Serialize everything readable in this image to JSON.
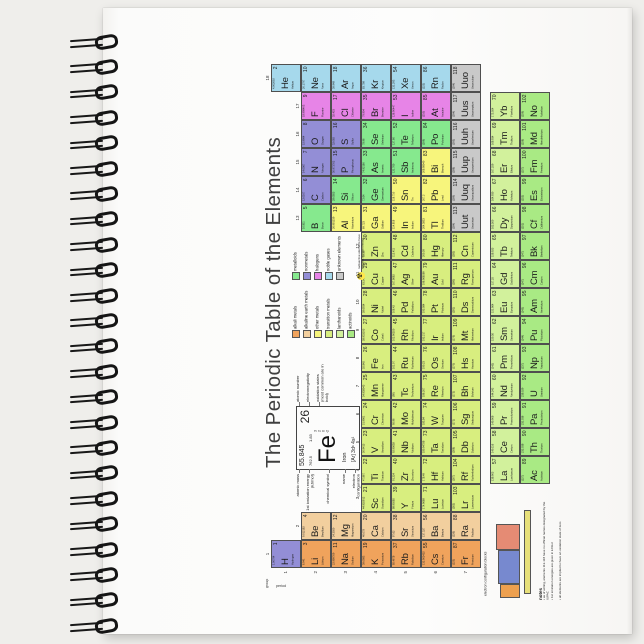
{
  "product": {
    "background_color": "#efeeeb",
    "page_color": "#fcfcfb",
    "spiral_coil_count": 24
  },
  "poster": {
    "title": "The Periodic Table of the Elements",
    "axis": {
      "group_word": "group",
      "period_word": "period",
      "group_numbers": [
        "1",
        "2",
        "3",
        "4",
        "5",
        "6",
        "7",
        "8",
        "9",
        "10",
        "11",
        "12",
        "13",
        "14",
        "15",
        "16",
        "17",
        "18"
      ],
      "period_numbers": [
        "1",
        "2",
        "3",
        "4",
        "5",
        "6",
        "7"
      ]
    },
    "categories": {
      "alk": {
        "label": "alkali metals",
        "color": "#f0a35c"
      },
      "ae": {
        "label": "alkaline earth metals",
        "color": "#f2cf9e"
      },
      "pm": {
        "label": "other metals",
        "color": "#f7f57c"
      },
      "tm": {
        "label": "transition metals",
        "color": "#d8ee7f"
      },
      "lan": {
        "label": "lanthanoids",
        "color": "#d2f19c"
      },
      "act": {
        "label": "actinoids",
        "color": "#a9ea84"
      },
      "md": {
        "label": "metalloids",
        "color": "#86e98e"
      },
      "nm": {
        "label": "nonmetals",
        "color": "#938ed6"
      },
      "hal": {
        "label": "halogens",
        "color": "#e784e7"
      },
      "ng": {
        "label": "noble gases",
        "color": "#a6d9ec"
      },
      "unk": {
        "label": "unknown elements",
        "color": "#c9c9c9"
      }
    },
    "legend": {
      "left_column": [
        "alk",
        "ae",
        "pm",
        "tm",
        "lan",
        "act"
      ],
      "right_column": [
        "md",
        "nm",
        "hal",
        "ng",
        "unk"
      ],
      "radioactive_icon": "☢",
      "radioactive_note": "radioactive elements have masses in parentheses"
    },
    "feature_cell": {
      "atomic_mass": "55.845",
      "ionization_energy": "762.5",
      "electronegativity": "1.83",
      "atomic_number": "26",
      "symbol": "Fe",
      "name": "Iron",
      "electron_configuration": "[Ar] 3d⁶ 4s²",
      "oxidation_states": [
        "3",
        "2",
        "0",
        "-2"
      ],
      "labels_left": [
        "atomic mass",
        "1st ionization energy (kJ/mol)",
        "chemical symbol",
        "name",
        "electron configuration"
      ],
      "labels_right": [
        "atomic number",
        "electronegativity",
        "oxidation states (most common are in bold)"
      ]
    },
    "blocks_diagram": {
      "caption": "electron configuration blocks",
      "blocks": [
        {
          "name": "s-block",
          "color": "#eda04f"
        },
        {
          "name": "d-block",
          "color": "#7789cf"
        },
        {
          "name": "p-block",
          "color": "#e58b74"
        },
        {
          "name": "f-block",
          "color": "#e7e07a"
        }
      ]
    },
    "notes": {
      "heading": "notes",
      "items": [
        "as of writing, elements 113-118 have no official names designated by the IUPAC",
        "1st ionization energies are given in kJ/mol",
        "all elements are implied to have an oxidation state of zero"
      ]
    },
    "element_fields": [
      "atomic_number",
      "symbol",
      "name",
      "atomic_mass",
      "column",
      "row",
      "category"
    ],
    "elements": [
      [
        1,
        "H",
        "Hydrogen",
        "1.00794",
        1,
        1,
        "nm"
      ],
      [
        2,
        "He",
        "Helium",
        "4.002602",
        18,
        1,
        "ng"
      ],
      [
        3,
        "Li",
        "Lithium",
        "6.941",
        1,
        2,
        "alk"
      ],
      [
        4,
        "Be",
        "Beryllium",
        "9.012182",
        2,
        2,
        "ae"
      ],
      [
        5,
        "B",
        "Boron",
        "10.811",
        13,
        2,
        "md"
      ],
      [
        6,
        "C",
        "Carbon",
        "12.0107",
        14,
        2,
        "nm"
      ],
      [
        7,
        "N",
        "Nitrogen",
        "14.0067",
        15,
        2,
        "nm"
      ],
      [
        8,
        "O",
        "Oxygen",
        "15.9994",
        16,
        2,
        "nm"
      ],
      [
        9,
        "F",
        "Fluorine",
        "18.998403",
        17,
        2,
        "hal"
      ],
      [
        10,
        "Ne",
        "Neon",
        "20.1797",
        18,
        2,
        "ng"
      ],
      [
        11,
        "Na",
        "Sodium",
        "22.989769",
        1,
        3,
        "alk"
      ],
      [
        12,
        "Mg",
        "Magnesium",
        "24.3050",
        2,
        3,
        "ae"
      ],
      [
        13,
        "Al",
        "Aluminium",
        "26.981539",
        13,
        3,
        "pm"
      ],
      [
        14,
        "Si",
        "Silicon",
        "28.0855",
        14,
        3,
        "md"
      ],
      [
        15,
        "P",
        "Phosphorus",
        "30.973762",
        15,
        3,
        "nm"
      ],
      [
        16,
        "S",
        "Sulfur",
        "32.065",
        16,
        3,
        "nm"
      ],
      [
        17,
        "Cl",
        "Chlorine",
        "35.453",
        17,
        3,
        "hal"
      ],
      [
        18,
        "Ar",
        "Argon",
        "39.948",
        18,
        3,
        "ng"
      ],
      [
        19,
        "K",
        "Potassium",
        "39.0983",
        1,
        4,
        "alk"
      ],
      [
        20,
        "Ca",
        "Calcium",
        "40.078",
        2,
        4,
        "ae"
      ],
      [
        21,
        "Sc",
        "Scandium",
        "44.955912",
        3,
        4,
        "tm"
      ],
      [
        22,
        "Ti",
        "Titanium",
        "47.867",
        4,
        4,
        "tm"
      ],
      [
        23,
        "V",
        "Vanadium",
        "50.9415",
        5,
        4,
        "tm"
      ],
      [
        24,
        "Cr",
        "Chromium",
        "51.9961",
        6,
        4,
        "tm"
      ],
      [
        25,
        "Mn",
        "Manganese",
        "54.938045",
        7,
        4,
        "tm"
      ],
      [
        26,
        "Fe",
        "Iron",
        "55.845",
        8,
        4,
        "tm"
      ],
      [
        27,
        "Co",
        "Cobalt",
        "58.933195",
        9,
        4,
        "tm"
      ],
      [
        28,
        "Ni",
        "Nickel",
        "58.6934",
        10,
        4,
        "tm"
      ],
      [
        29,
        "Cu",
        "Copper",
        "63.546",
        11,
        4,
        "tm"
      ],
      [
        30,
        "Zn",
        "Zinc",
        "65.38",
        12,
        4,
        "tm"
      ],
      [
        31,
        "Ga",
        "Gallium",
        "69.723",
        13,
        4,
        "pm"
      ],
      [
        32,
        "Ge",
        "Germanium",
        "72.64",
        14,
        4,
        "md"
      ],
      [
        33,
        "As",
        "Arsenic",
        "74.92160",
        15,
        4,
        "md"
      ],
      [
        34,
        "Se",
        "Selenium",
        "78.96",
        16,
        4,
        "md"
      ],
      [
        35,
        "Br",
        "Bromine",
        "79.904",
        17,
        4,
        "hal"
      ],
      [
        36,
        "Kr",
        "Krypton",
        "83.798",
        18,
        4,
        "ng"
      ],
      [
        37,
        "Rb",
        "Rubidium",
        "85.4678",
        1,
        5,
        "alk"
      ],
      [
        38,
        "Sr",
        "Strontium",
        "87.62",
        2,
        5,
        "ae"
      ],
      [
        39,
        "Y",
        "Yttrium",
        "88.90585",
        3,
        5,
        "tm"
      ],
      [
        40,
        "Zr",
        "Zirconium",
        "91.224",
        4,
        5,
        "tm"
      ],
      [
        41,
        "Nb",
        "Niobium",
        "92.90638",
        5,
        5,
        "tm"
      ],
      [
        42,
        "Mo",
        "Molybdenum",
        "95.96",
        6,
        5,
        "tm"
      ],
      [
        43,
        "Tc",
        "Technetium",
        "(98)",
        7,
        5,
        "tm"
      ],
      [
        44,
        "Ru",
        "Ruthenium",
        "101.07",
        8,
        5,
        "tm"
      ],
      [
        45,
        "Rh",
        "Rhodium",
        "102.90550",
        9,
        5,
        "tm"
      ],
      [
        46,
        "Pd",
        "Palladium",
        "106.42",
        10,
        5,
        "tm"
      ],
      [
        47,
        "Ag",
        "Silver",
        "107.8682",
        11,
        5,
        "tm"
      ],
      [
        48,
        "Cd",
        "Cadmium",
        "112.411",
        12,
        5,
        "tm"
      ],
      [
        49,
        "In",
        "Indium",
        "114.818",
        13,
        5,
        "pm"
      ],
      [
        50,
        "Sn",
        "Tin",
        "118.710",
        14,
        5,
        "pm"
      ],
      [
        51,
        "Sb",
        "Antimony",
        "121.760",
        15,
        5,
        "md"
      ],
      [
        52,
        "Te",
        "Tellurium",
        "127.60",
        16,
        5,
        "md"
      ],
      [
        53,
        "I",
        "Iodine",
        "126.90447",
        17,
        5,
        "hal"
      ],
      [
        54,
        "Xe",
        "Xenon",
        "131.293",
        18,
        5,
        "ng"
      ],
      [
        55,
        "Cs",
        "Caesium",
        "132.905452",
        1,
        6,
        "alk"
      ],
      [
        56,
        "Ba",
        "Barium",
        "137.327",
        2,
        6,
        "ae"
      ],
      [
        57,
        "La",
        "Lanthanum",
        "138.905",
        4,
        8,
        "lan"
      ],
      [
        58,
        "Ce",
        "Cerium",
        "140.116",
        5,
        8,
        "lan"
      ],
      [
        59,
        "Pr",
        "Praseodymium",
        "140.908",
        6,
        8,
        "lan"
      ],
      [
        60,
        "Nd",
        "Neodymium",
        "144.242",
        7,
        8,
        "lan"
      ],
      [
        61,
        "Pm",
        "Promethium",
        "(145)",
        8,
        8,
        "lan"
      ],
      [
        62,
        "Sm",
        "Samarium",
        "150.36",
        9,
        8,
        "lan"
      ],
      [
        63,
        "Eu",
        "Europium",
        "151.964",
        10,
        8,
        "lan"
      ],
      [
        64,
        "Gd",
        "Gadolinium",
        "157.25",
        11,
        8,
        "lan"
      ],
      [
        65,
        "Tb",
        "Terbium",
        "158.925",
        12,
        8,
        "lan"
      ],
      [
        66,
        "Dy",
        "Dysprosium",
        "162.500",
        13,
        8,
        "lan"
      ],
      [
        67,
        "Ho",
        "Holmium",
        "164.930",
        14,
        8,
        "lan"
      ],
      [
        68,
        "Er",
        "Erbium",
        "167.259",
        15,
        8,
        "lan"
      ],
      [
        69,
        "Tm",
        "Thulium",
        "168.934",
        16,
        8,
        "lan"
      ],
      [
        70,
        "Yb",
        "Ytterbium",
        "173.054",
        17,
        8,
        "lan"
      ],
      [
        71,
        "Lu",
        "Lutetium",
        "174.9668",
        3,
        6,
        "tm"
      ],
      [
        72,
        "Hf",
        "Hafnium",
        "178.49",
        4,
        6,
        "tm"
      ],
      [
        73,
        "Ta",
        "Tantalum",
        "180.94788",
        5,
        6,
        "tm"
      ],
      [
        74,
        "W",
        "Tungsten",
        "183.84",
        6,
        6,
        "tm"
      ],
      [
        75,
        "Re",
        "Rhenium",
        "186.207",
        7,
        6,
        "tm"
      ],
      [
        76,
        "Os",
        "Osmium",
        "190.23",
        8,
        6,
        "tm"
      ],
      [
        77,
        "Ir",
        "Iridium",
        "192.217",
        9,
        6,
        "tm"
      ],
      [
        78,
        "Pt",
        "Platinum",
        "195.084",
        10,
        6,
        "tm"
      ],
      [
        79,
        "Au",
        "Gold",
        "196.966569",
        11,
        6,
        "tm"
      ],
      [
        80,
        "Hg",
        "Mercury",
        "200.59",
        12,
        6,
        "tm"
      ],
      [
        81,
        "Tl",
        "Thallium",
        "204.3833",
        13,
        6,
        "pm"
      ],
      [
        82,
        "Pb",
        "Lead",
        "207.2",
        14,
        6,
        "pm"
      ],
      [
        83,
        "Bi",
        "Bismuth",
        "208.98040",
        15,
        6,
        "pm"
      ],
      [
        84,
        "Po",
        "Polonium",
        "(209)",
        16,
        6,
        "md"
      ],
      [
        85,
        "At",
        "Astatine",
        "(210)",
        17,
        6,
        "hal"
      ],
      [
        86,
        "Rn",
        "Radon",
        "(222)",
        18,
        6,
        "ng"
      ],
      [
        87,
        "Fr",
        "Francium",
        "(223)",
        1,
        7,
        "alk"
      ],
      [
        88,
        "Ra",
        "Radium",
        "(226)",
        2,
        7,
        "ae"
      ],
      [
        89,
        "Ac",
        "Actinium",
        "(227)",
        4,
        9,
        "act"
      ],
      [
        90,
        "Th",
        "Thorium",
        "232.038",
        5,
        9,
        "act"
      ],
      [
        91,
        "Pa",
        "Protactinium",
        "231.036",
        6,
        9,
        "act"
      ],
      [
        92,
        "U",
        "Uranium",
        "238.029",
        7,
        9,
        "act"
      ],
      [
        93,
        "Np",
        "Neptunium",
        "(237)",
        8,
        9,
        "act"
      ],
      [
        94,
        "Pu",
        "Plutonium",
        "(244)",
        9,
        9,
        "act"
      ],
      [
        95,
        "Am",
        "Americium",
        "(243)",
        10,
        9,
        "act"
      ],
      [
        96,
        "Cm",
        "Curium",
        "(247)",
        11,
        9,
        "act"
      ],
      [
        97,
        "Bk",
        "Berkelium",
        "(247)",
        12,
        9,
        "act"
      ],
      [
        98,
        "Cf",
        "Californium",
        "(251)",
        13,
        9,
        "act"
      ],
      [
        99,
        "Es",
        "Einsteinium",
        "(252)",
        14,
        9,
        "act"
      ],
      [
        100,
        "Fm",
        "Fermium",
        "(257)",
        15,
        9,
        "act"
      ],
      [
        101,
        "Md",
        "Mendelevium",
        "(258)",
        16,
        9,
        "act"
      ],
      [
        102,
        "No",
        "Nobelium",
        "(259)",
        17,
        9,
        "act"
      ],
      [
        103,
        "Lr",
        "Lawrencium",
        "(262)",
        3,
        7,
        "tm"
      ],
      [
        104,
        "Rf",
        "Rutherfordium",
        "(267)",
        4,
        7,
        "tm"
      ],
      [
        105,
        "Db",
        "Dubnium",
        "(268)",
        5,
        7,
        "tm"
      ],
      [
        106,
        "Sg",
        "Seaborgium",
        "(271)",
        6,
        7,
        "tm"
      ],
      [
        107,
        "Bh",
        "Bohrium",
        "(272)",
        7,
        7,
        "tm"
      ],
      [
        108,
        "Hs",
        "Hassium",
        "(270)",
        8,
        7,
        "tm"
      ],
      [
        109,
        "Mt",
        "Meitnerium",
        "(276)",
        9,
        7,
        "tm"
      ],
      [
        110,
        "Ds",
        "Darmstadtium",
        "(281)",
        10,
        7,
        "tm"
      ],
      [
        111,
        "Rg",
        "Roentgenium",
        "(280)",
        11,
        7,
        "tm"
      ],
      [
        112,
        "Cn",
        "Copernicium",
        "(285)",
        12,
        7,
        "tm"
      ],
      [
        113,
        "Uut",
        "Ununtrium",
        "(284)",
        13,
        7,
        "unk"
      ],
      [
        114,
        "Uuq",
        "Ununquadium",
        "(289)",
        14,
        7,
        "unk"
      ],
      [
        115,
        "Uup",
        "Ununpentium",
        "(288)",
        15,
        7,
        "unk"
      ],
      [
        116,
        "Uuh",
        "Ununhexium",
        "(293)",
        16,
        7,
        "unk"
      ],
      [
        117,
        "Uus",
        "Ununseptium",
        "(294)",
        17,
        7,
        "unk"
      ],
      [
        118,
        "Uuo",
        "Ununoctium",
        "(294)",
        18,
        7,
        "unk"
      ]
    ]
  }
}
